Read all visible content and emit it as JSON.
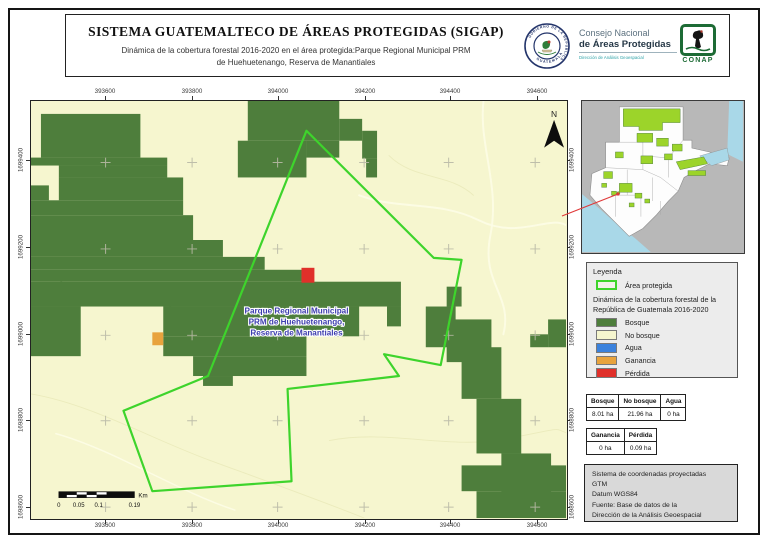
{
  "header": {
    "title": "SISTEMA GUATEMALTECO DE ÁREAS PROTEGIDAS  (SIGAP)",
    "subtitle_line1": "Dinámica de la cobertura forestal 2016-2020 en el área protegida:Parque Regional Municipal PRM",
    "subtitle_line2": "de Huehuetenango, Reserva de Manantiales",
    "seal_text_top": "GOBIERNO DE LA REPÚBLICA",
    "seal_text_bottom": "GUATEMALA",
    "org_line1": "Consejo Nacional",
    "org_line2": "de Áreas Protegidas",
    "org_line3": "Dirección de Análisis Geoespacial",
    "conap_label": "CONAP"
  },
  "map": {
    "x_tick_labels": [
      "393600",
      "393800",
      "394000",
      "394200",
      "394400",
      "394600"
    ],
    "y_tick_labels": [
      "1699400",
      "1699200",
      "1699000",
      "1698800",
      "1698600"
    ],
    "north_label": "N",
    "area_label_lines": [
      "Parque Regional Municipal",
      "PRM de Huehuetenango,",
      "Reserva de Manantiales"
    ],
    "scalebar": {
      "labels": [
        "0",
        "0.05",
        "0.1",
        "0.19"
      ],
      "unit": "Km"
    }
  },
  "legend": {
    "title": "Leyenda",
    "area_item_label": "Área protegida",
    "subtitle_line1": "Dinámica de la cobertura forestal de la",
    "subtitle_line2": "República de Guatemala 2016-2020",
    "items": [
      {
        "label": "Bosque",
        "color": "#4e7e3c"
      },
      {
        "label": "No bosque",
        "color": "#f6f6cf"
      },
      {
        "label": "Agua",
        "color": "#3b82dd"
      },
      {
        "label": "Ganancia",
        "color": "#e8a33d"
      },
      {
        "label": "Pérdida",
        "color": "#e0302a"
      }
    ]
  },
  "tables": {
    "coverage": {
      "headers": [
        "Bosque",
        "No bosque",
        "Agua"
      ],
      "values": [
        "8.01 ha",
        "21.96 ha",
        "0 ha"
      ]
    },
    "change": {
      "headers": [
        "Ganancia",
        "Pérdida"
      ],
      "values": [
        "0 ha",
        "0.09 ha"
      ]
    }
  },
  "credits": {
    "lines": [
      "Sistema de coordenadas proyectadas",
      "GTM",
      "Datum WGS84",
      "Fuente: Base de datos de la",
      "Dirección de la Análisis Geoespacial"
    ]
  },
  "colors": {
    "bosque": "#4e7e3c",
    "no_bosque": "#f6f6cf",
    "agua": "#3b82dd",
    "ganancia": "#e8a33d",
    "perdida": "#e0302a",
    "boundary": "#3ed42c",
    "inset_protected": "#9cd42a",
    "inset_water": "#a9d8e8",
    "leader_red": "#e03a3a"
  }
}
